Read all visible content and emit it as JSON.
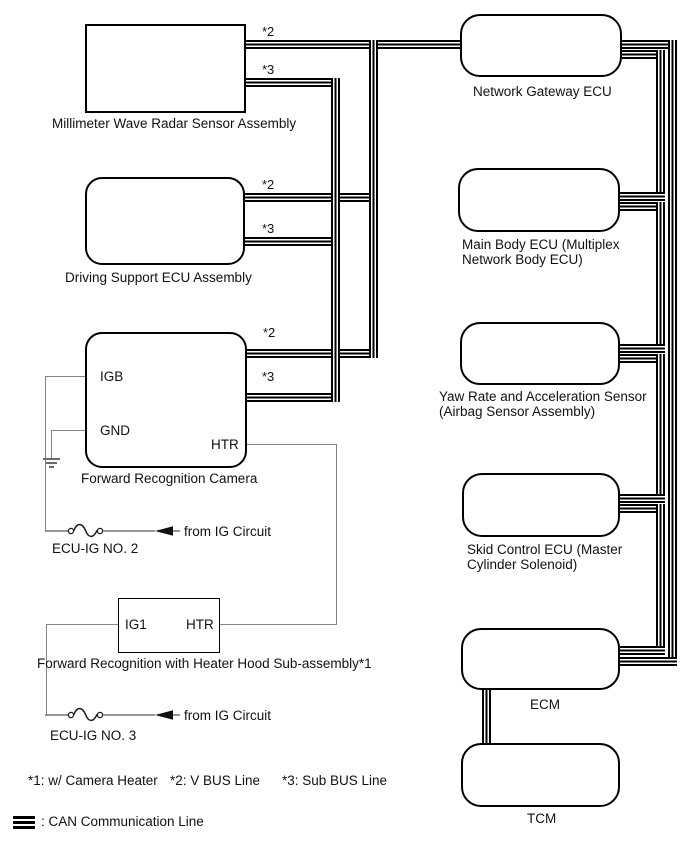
{
  "diagram": {
    "nodes": {
      "radar": {
        "label": "Millimeter Wave Radar Sensor Assembly"
      },
      "driving_support": {
        "label": "Driving Support ECU Assembly"
      },
      "camera": {
        "label": "Forward Recognition Camera",
        "pin_igb": "IGB",
        "pin_gnd": "GND",
        "pin_htr": "HTR"
      },
      "heater_hood": {
        "label": "Forward Recognition with Heater Hood Sub-assembly*1",
        "pin_ig1": "IG1",
        "pin_htr": "HTR"
      },
      "network_gateway": {
        "label": "Network Gateway ECU"
      },
      "main_body": {
        "label1": "Main Body ECU (Multiplex",
        "label2": "Network Body ECU)"
      },
      "yaw_rate": {
        "label1": "Yaw Rate and Acceleration Sensor",
        "label2": "(Airbag Sensor Assembly)"
      },
      "skid_control": {
        "label1": "Skid Control ECU (Master",
        "label2": "Cylinder Solenoid)"
      },
      "ecm": {
        "label": "ECM"
      },
      "tcm": {
        "label": "TCM"
      }
    },
    "bus_markers": {
      "v_bus": "*2",
      "sub_bus": "*3"
    },
    "power": {
      "fuse2_label": "ECU-IG NO. 2",
      "fuse3_label": "ECU-IG NO. 3",
      "from_ig_label": "from IG Circuit"
    },
    "footnotes": {
      "f1": "*1: w/ Camera Heater",
      "f2": "*2: V BUS Line",
      "f3": "*3: Sub BUS Line"
    },
    "legend": {
      "can_line": ": CAN Communication Line"
    },
    "colors": {
      "can_line": "#000000",
      "wire": "#848484",
      "text": "#111111",
      "background": "#ffffff"
    }
  }
}
